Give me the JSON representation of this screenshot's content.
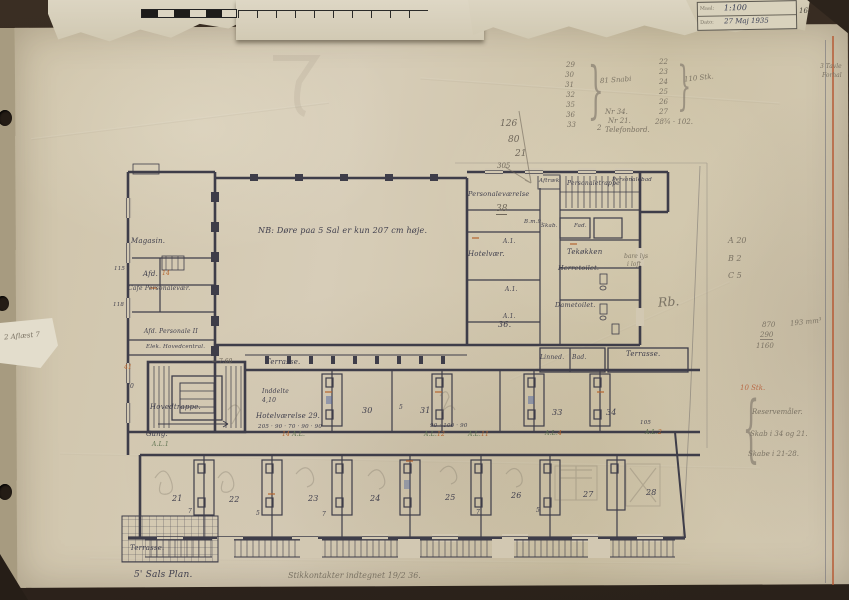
{
  "stamp": {
    "row1_label": "Maal:",
    "row1_value": "1:100",
    "row2_label": "Dato:",
    "row2_value": "27 Maj 1935",
    "side_mark": "16."
  },
  "notes": {
    "nb": "NB: Døre paa 5 Sal er kun 207 cm høje.",
    "title": "5' Sals Plan.",
    "title_annotation": "Stikkontakter indtegnet 19/2 36."
  },
  "rooms": {
    "magasin": "Magasin.",
    "afd": "Afd.",
    "cafe_personalevaer": "Café Personalevær.",
    "afd_personale": "Afd. Personale II",
    "elek": "Elek. Hovedcentral.",
    "hovedtrappe": "Hovedtrappe.",
    "terrasse_mid": "Terrasse.",
    "terrasse_right": "Terrasse.",
    "terrasse_bottom": "Terrasse.",
    "gang": "Gang.",
    "inddelte_line1": "Inddelte",
    "inddelte_line2": "4,10",
    "hotelvaerelse_29": "Hotelværelse 29.",
    "hotelvaer": "Hotelvær.",
    "personalevaerelse": "Personaleværelse",
    "personaletrappe": "Personaletrappe",
    "personalebad": "Personalebad",
    "aftraek": "Aftræk",
    "tekokken": "Tekøkken",
    "herretoilet": "Herretoilet.",
    "dametoilet": "Dametoilet.",
    "skab": "Skab.",
    "fad": "Fad.",
    "linned": "Linned.",
    "bad": "Bad."
  },
  "marks": {
    "al": "A.L.",
    "al1": "A.L.1",
    "n14": "14",
    "n12": "12",
    "n11": "11",
    "n4": "4",
    "n2": "2",
    "a1": "A.1.",
    "n36": "36.",
    "n30": "30",
    "n31": "31",
    "n33": "33",
    "n34": "34",
    "n5": "5",
    "n7": "7",
    "bm9": "B.m.9.",
    "dims29": "205 · 90 · 70 · 90 · 90",
    "dims32": "90 · 100 · 90",
    "dims_right": "105",
    "n115": "115",
    "n118": "118",
    "n41": "41",
    "n70": "70",
    "trappe_dim": "← 7.60"
  },
  "bottom_numbers": [
    "21",
    "22",
    "23",
    "24",
    "25",
    "26",
    "27",
    "28"
  ],
  "pencil": {
    "v126": "126",
    "v80": "80",
    "v21": "21",
    "v305": "305",
    "n38": "38",
    "rb": "Rb.",
    "lys1": "bare lys",
    "lys2": "i loft",
    "col1": [
      "29",
      "30",
      "31",
      "32",
      "35",
      "36",
      "33"
    ],
    "col1_note": "81 Snabi",
    "col1_extra": "2",
    "col2": [
      "22",
      "23",
      "24",
      "25",
      "26",
      "27"
    ],
    "col2_note": "110 Stk.",
    "sum_line": "28¾ · 102.",
    "nr34": "Nr 34.",
    "nr21": "Nr 21.",
    "tel": "Telefonbord.",
    "abc0": "A  20",
    "abc1": "B  2",
    "abc2": "C  5",
    "s870": "870",
    "s290": "290",
    "s1160": "1160",
    "mm": "193 mm³",
    "low0": "10 Stk.",
    "low1": "Reservemåler.",
    "low2": "Skab i 34 og 21.",
    "low3": "Skabe i 21-28.",
    "left_edge": "2 Aflæst 7",
    "edge_r1": "3 Tavle",
    "edge_r2": "Forhal"
  },
  "colors": {
    "paper": "#d2c8b2",
    "ink": "#3e3d49",
    "pencil": "#7b7364",
    "orange": "#b5652f",
    "green": "#5e7350",
    "blue": "#54689f"
  }
}
